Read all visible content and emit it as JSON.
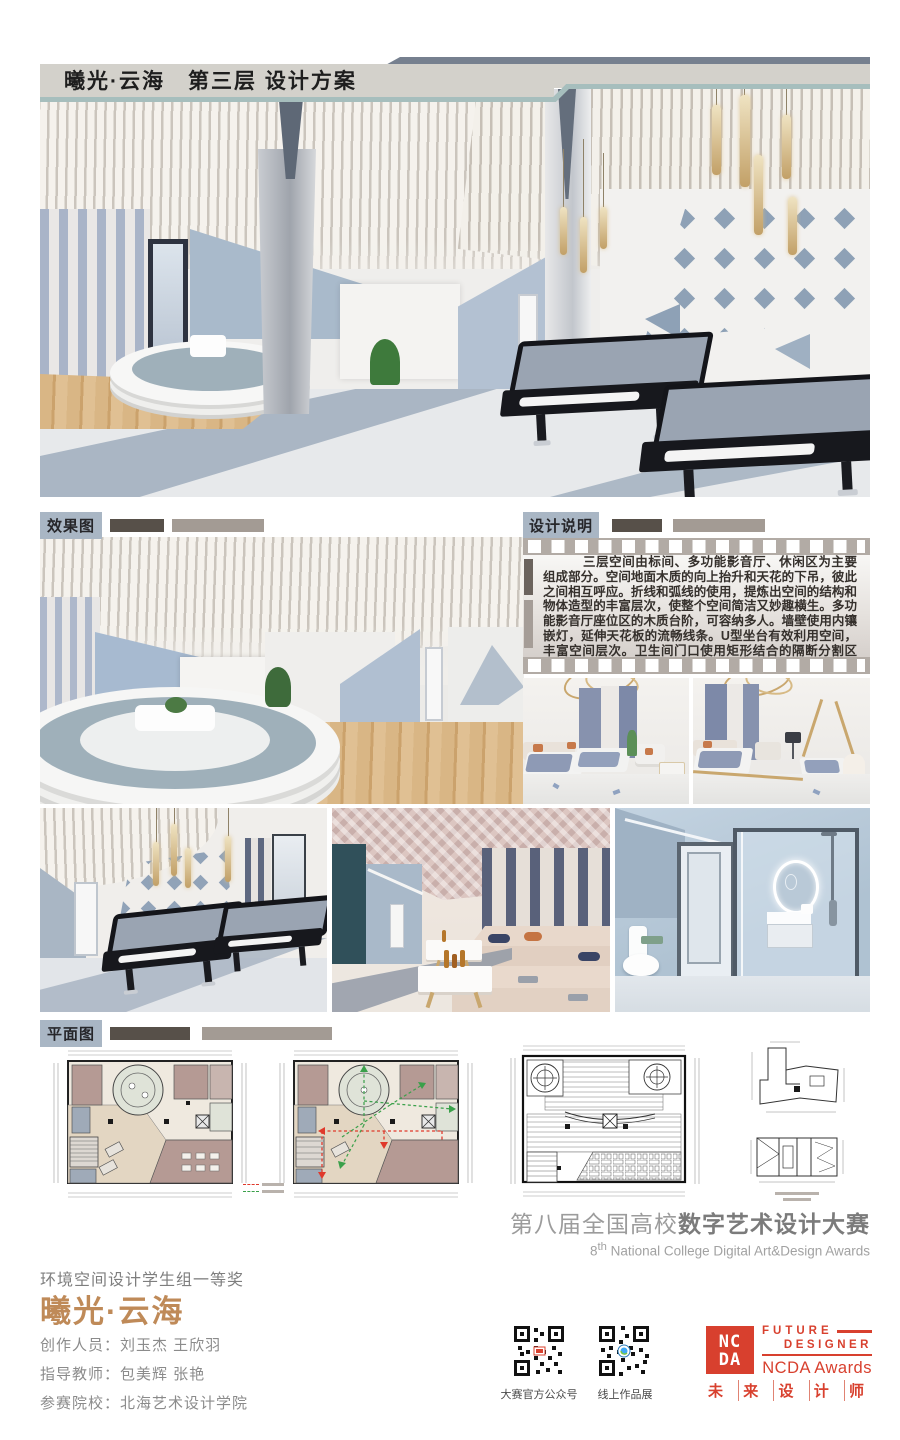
{
  "header": {
    "title": "曦光·云海　第三层 设计方案"
  },
  "labels": {
    "renders": "效果图",
    "description": "设计说明",
    "plans": "平面图"
  },
  "description_text": "三层空间由标间、多功能影音厅、休闲区为主要组成部分。空间地面木质的向上抬升和天花的下吊，彼此之间相互呼应。折线和弧线的使用，提炼出空间的结构和物体造型的丰富层次，使整个空间简洁又妙趣横生。多功能影音厅座位区的木质台阶，可容纳多人。墙壁使用内镶嵌灯，延伸天花板的流畅线条。U型坐台有效利用空间，丰富空间层次。卫生间门口使用矩形结合的隔断分割区域。",
  "competition": {
    "cn_light": "第八届全国高校",
    "cn_bold": "数字艺术设计大赛",
    "en_num": "8",
    "en_sup": "th",
    "en_rest": " National College Digital Art&Design Awards"
  },
  "award": {
    "category": "环境空间设计学生组一等奖",
    "title": "曦光·云海",
    "credits": [
      {
        "label": "创作人员：",
        "value": "刘玉杰 王欣羽"
      },
      {
        "label": "指导教师：",
        "value": "包美辉 张艳"
      },
      {
        "label": "参赛院校：",
        "value": "北海艺术设计学院"
      }
    ]
  },
  "qr_codes": [
    {
      "label": "大赛官方公众号"
    },
    {
      "label": "线上作品展"
    }
  ],
  "ncda": {
    "badge_top": "NC",
    "badge_bottom": "DA",
    "future": "FUTURE",
    "designer": "DESIGNER",
    "awards": "NCDA Awards",
    "motto": [
      "未",
      "来",
      "设",
      "计",
      "师"
    ]
  },
  "colors": {
    "accent_red": "#D8402E",
    "gold": "#BF8A58",
    "slate_bar": "#76808F",
    "header_band": "#D3D1CB",
    "teal_line": "#A6BEBD",
    "label_bg": "#A9B6C4"
  }
}
